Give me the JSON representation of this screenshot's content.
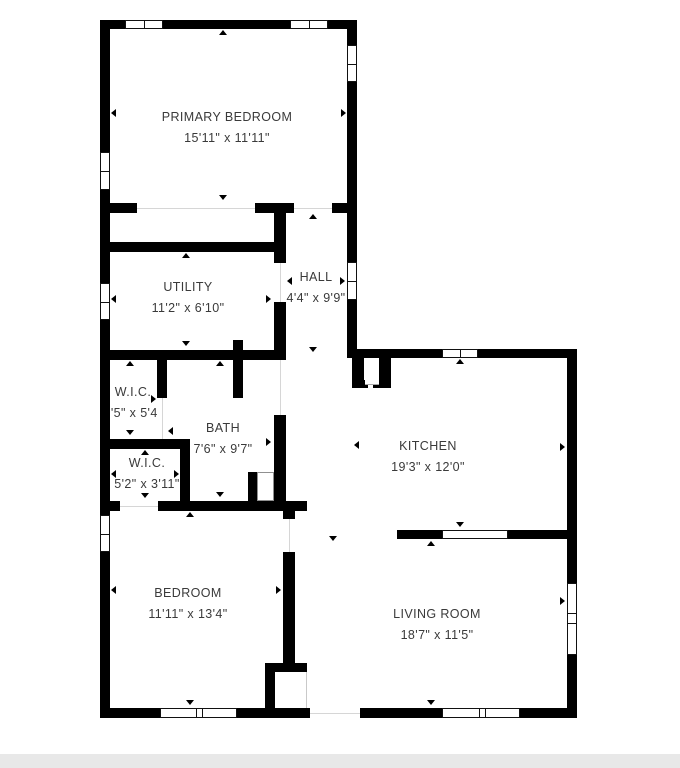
{
  "plan": {
    "type": "floor-plan",
    "wall_color": "#000000",
    "label_color": "#3a3a3a",
    "window_fill": "#ffffff",
    "footer_band_color": "#e8e8e8",
    "rooms": [
      {
        "id": "primary-bedroom",
        "name": "PRIMARY BEDROOM",
        "dims": "15'11\" x 11'11\""
      },
      {
        "id": "utility",
        "name": "UTILITY",
        "dims": "11'2\" x 6'10\""
      },
      {
        "id": "hall",
        "name": "HALL",
        "dims": "4'4\" x 9'9\""
      },
      {
        "id": "wic-1",
        "name": "W.I.C.",
        "dims": "3'5\" x 5'4\""
      },
      {
        "id": "bath",
        "name": "BATH",
        "dims": "7'6\" x 9'7\""
      },
      {
        "id": "wic-2",
        "name": "W.I.C.",
        "dims": "5'2\" x 3'11\""
      },
      {
        "id": "bedroom",
        "name": "BEDROOM",
        "dims": "11'11\" x 13'4\""
      },
      {
        "id": "kitchen",
        "name": "KITCHEN",
        "dims": "19'3\" x 12'0\""
      },
      {
        "id": "living-room",
        "name": "LIVING ROOM",
        "dims": "18'7\" x 11'5\""
      }
    ]
  }
}
